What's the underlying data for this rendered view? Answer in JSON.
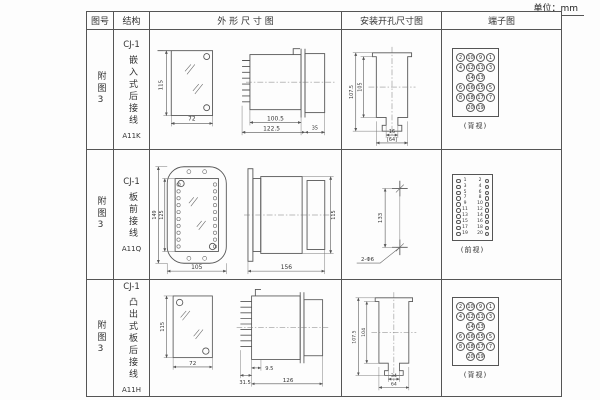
{
  "page": {
    "unit_label": "单位：mm"
  },
  "table": {
    "headers": [
      "图号",
      "结构",
      "外 形 尺 寸 图",
      "安装开孔尺寸图",
      "端子图"
    ],
    "rows": [
      {
        "fig_no": "附图3",
        "model": "CJ-1",
        "structure": "嵌入式后接线",
        "code": "A11K",
        "outline": {
          "height": "115",
          "width": "72",
          "body_len": "100.5",
          "overall_len": "122.5",
          "rear_len": "35"
        },
        "install": {
          "v_outer": "107.5",
          "v_inner": "105",
          "slot_w": "16",
          "hole_w": "[64]"
        },
        "terminal_view": "(背视)",
        "terminals": [
          [
            "2",
            "10",
            "9",
            "1"
          ],
          [
            "4",
            "12",
            "11",
            "3"
          ],
          [
            "",
            "14",
            "13",
            ""
          ],
          [
            "6",
            "16",
            "15",
            "5"
          ],
          [
            "8",
            "18",
            "17",
            "7"
          ],
          [
            "",
            "20",
            "19",
            ""
          ]
        ]
      },
      {
        "fig_no": "附图3",
        "model": "CJ-1",
        "structure": "板前接线",
        "code": "A11Q",
        "outline": {
          "plate_h": "149",
          "inner_h": "125",
          "plate_w": "105",
          "length": "156",
          "height": "115"
        },
        "install": {
          "spacing": "133",
          "hole_label": "2-Φ6"
        },
        "terminal_view": "(前视)",
        "terminals_left": [
          "1",
          "3",
          "5",
          "7",
          "9",
          "11",
          "13",
          "15",
          "17",
          "19"
        ],
        "terminals_right": [
          "2",
          "4",
          "6",
          "8",
          "10",
          "12",
          "14",
          "16",
          "18",
          "20"
        ]
      },
      {
        "fig_no": "附图3",
        "model": "CJ-1",
        "structure": "凸出式板后接线",
        "code": "A11H",
        "outline": {
          "height": "115",
          "width": "72",
          "term_len": "31.5",
          "step": "9.5",
          "length": "126"
        },
        "install": {
          "v_outer": "107.5",
          "v_inner": "104",
          "slot_w": "34",
          "hole_w": "64"
        },
        "terminal_view": "(背视)",
        "terminals": [
          [
            "2",
            "10",
            "9",
            "1"
          ],
          [
            "4",
            "12",
            "11",
            "3"
          ],
          [
            "",
            "14",
            "13",
            ""
          ],
          [
            "6",
            "16",
            "15",
            "5"
          ],
          [
            "8",
            "18",
            "17",
            "7"
          ],
          [
            "",
            "20",
            "19",
            ""
          ]
        ]
      }
    ]
  }
}
